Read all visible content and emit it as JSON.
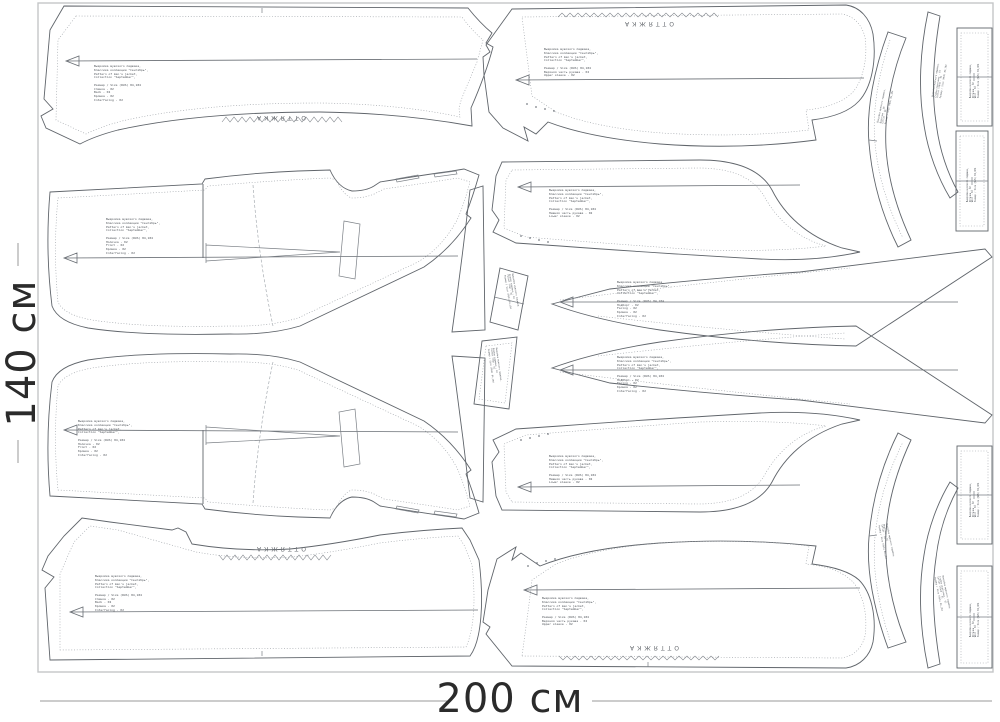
{
  "dimensions": {
    "width_label": "200 см",
    "height_label": "140 см"
  },
  "labels": {
    "stretch": "ОТТЯЖКА"
  },
  "pieces": {
    "back_top": {
      "text": "Выкройка мужского пиджака,\nКлассика коллекции \"Сентябрь\",\nPattern of men's jacket,\nCollection \"September\",\n\nРазмер / Size (RUS) 84,184\nСпинка - 02\nBack - 02\nКромка - 02\nInterfacing - 02"
    },
    "upper_sleeve_top": {
      "text": "Выкройка мужского пиджака,\nКлассика коллекции \"Сентябрь\",\nPattern of men's jacket,\nCollection \"September\",\n\nРазмер / Size (RUS) 84,184\nВерхняя часть рукава - 02\nUpper sleeve - 02"
    },
    "front_top": {
      "text": "Выкройка мужского пиджака,\nКлассика коллекции \"Сентябрь\",\nPattern of men's jacket,\nCollection \"September\",\n\nРазмер / Size (RUS) 84,184\nПолочка - 02\nFront - 02\nКромка - 02\nInterfacing - 02"
    },
    "front_bottom": {
      "text": "Выкройка мужского пиджака,\nКлассика коллекции \"Сентябрь\",\nPattern of men's jacket,\nCollection \"September\",\n\nРазмер / Size (RUS) 84,184\nПолочка - 02\nFront - 02\nКромка - 02\nInterfacing - 02"
    },
    "back_bottom": {
      "text": "Выкройка мужского пиджака,\nКлассика коллекции \"Сентябрь\",\nPattern of men's jacket,\nCollection \"September\",\n\nРазмер / Size (RUS) 84,184\nСпинка - 02\nBack - 02\nКромка - 02\nInterfacing - 02"
    },
    "under_sleeve_top": {
      "text": "Выкройка мужского пиджака,\nКлассика коллекции \"Сентябрь\",\nPattern of men's jacket,\nCollection \"September\",\n\nРазмер / Size (RUS) 84,184\nНижняя часть рукава - 02\nLower sleeve - 02"
    },
    "facing_top": {
      "text": "Выкройка мужского пиджака,\nКлассика коллекции \"Сентябрь\",\nPattern of men's jacket,\nCollection \"September\",\n\nРазмер / Size (RUS) 84,184\nПодборт - 02\nFacing - 02\nКромка - 02\nInterfacing - 02"
    },
    "facing_bottom": {
      "text": "Выкройка мужского пиджака,\nКлассика коллекции \"Сентябрь\",\nPattern of men's jacket,\nCollection \"September\",\n\nРазмер / Size (RUS) 84,184\nПодборт - 02\nFacing - 02\nКромка - 02\nInterfacing - 02"
    },
    "under_sleeve_bottom": {
      "text": "Выкройка мужского пиджака,\nКлассика коллекции \"Сентябрь\",\nPattern of men's jacket,\nCollection \"September\",\n\nРазмер / Size (RUS) 84,184\nНижняя часть рукава - 02\nLower sleeve - 02"
    },
    "upper_sleeve_bottom": {
      "text": "Выкройка мужского пиджака,\nКлассика коллекции \"Сентябрь\",\nPattern of men's jacket,\nCollection \"September\",\n\nРазмер / Size (RUS) 84,184\nВерхняя часть рукава - 02\nUpper sleeve - 02"
    },
    "collar_top": {
      "text": "Выкройка мужского пиджака,\nВоротник - 01\nCollar - 01\nРазмер / Size (RUS) 84,184"
    },
    "collar_stand_top": {
      "text": "Выкройка мужского пиджака,\nСтойка воротника - 01\nCollar stand - 01\nРазмер / Size (RUS) 84,184"
    },
    "strip_top_1": {
      "text": "Выкройка мужского пиджака,\nОбтачка - 02\nWelt - 02\nРазмер / Size (RUS) 84,184"
    },
    "strip_top_2": {
      "text": "Выкройка мужского пиджака,\nОбтачка - 02\nWelt - 02\nРазмер / Size (RUS) 84,184"
    },
    "collar_bottom": {
      "text": "Выкройка мужского пиджака,\nВоротник - 01\nCollar - 01\nРазмер / Size (RUS) 84,184"
    },
    "collar_stand_bottom": {
      "text": "Выкройка мужского пиджака,\nСтойка воротника - 01\nCollar stand - 01\nРазмер / Size (RUS) 84,184"
    },
    "strip_bottom_1": {
      "text": "Выкройка мужского пиджака,\nОбтачка - 02\nWelt - 02\nРазмер / Size (RUS) 84,184"
    },
    "strip_bottom_2": {
      "text": "Выкройка мужского пиджака,\nОбтачка - 02\nWelt - 02\nРазмер / Size (RUS) 84,184"
    },
    "welt_center_1": {
      "text": "Выкройка мужского пиджака,\nКлапан кармана - 02\nPocket flap - 02\nРазмер / Size (RUS) 84,184"
    },
    "welt_center_2": {
      "text": "Выкройка мужского пиджака,\nКлапан кармана - 02\nPocket flap - 02\nРазмер / Size (RUS) 84,184"
    }
  }
}
